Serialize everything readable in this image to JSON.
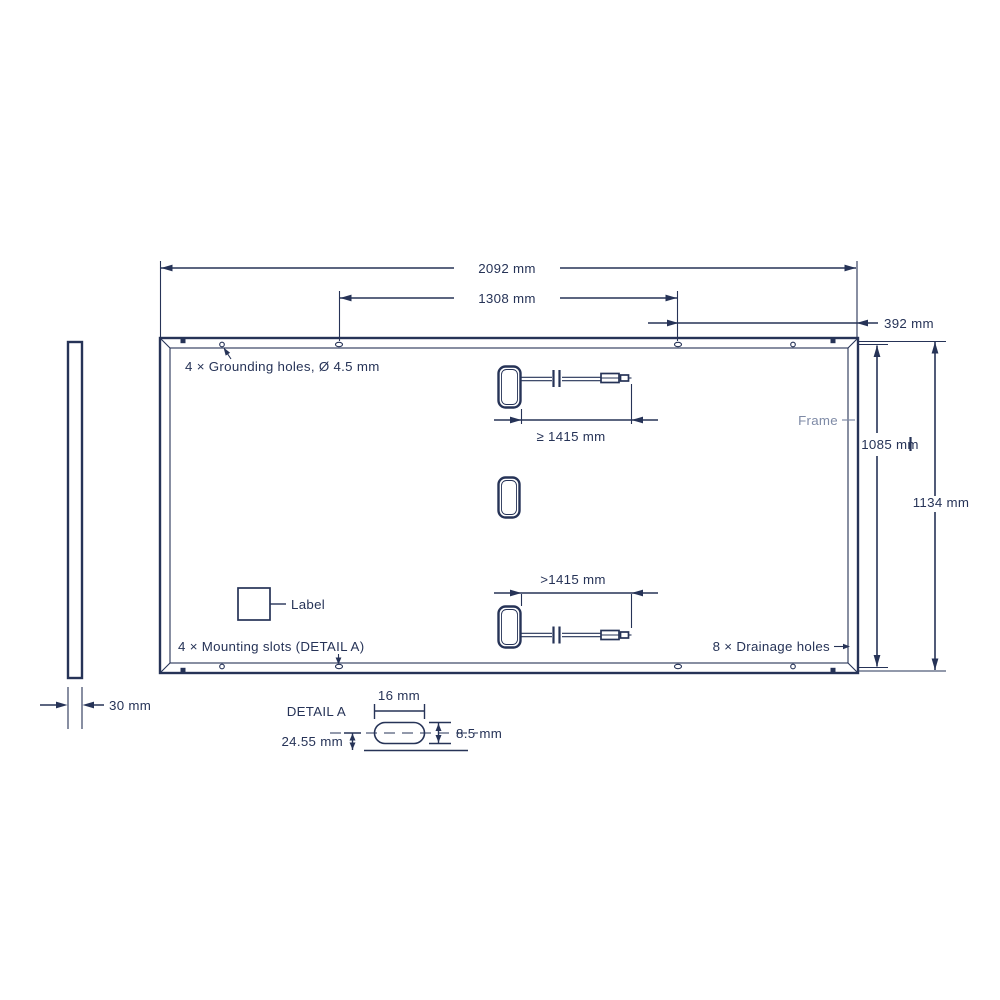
{
  "colors": {
    "ink": "#263357",
    "muted": "#7E8AA6"
  },
  "side_view": {
    "thickness": "30 mm"
  },
  "panel": {
    "width_overall": "2092 mm",
    "slot_span": "1308 mm",
    "slot_edge_offset": "392 mm",
    "height_inner": "1085 mm",
    "height_overall": "1134 mm",
    "grounding_note": "4 × Grounding holes, Ø 4.5 mm",
    "frame_label": "Frame",
    "label_tag": "Label",
    "mounting_note": "4 × Mounting slots (DETAIL A)",
    "drainage_note": "8 × Drainage holes"
  },
  "cables": {
    "top_length": "≥ 1415 mm",
    "bottom_length": ">1415 mm"
  },
  "detail_a": {
    "title": "DETAIL A",
    "slot_width": "16 mm",
    "slot_height": "8.5 mm",
    "center_offset": "24.55 mm"
  }
}
